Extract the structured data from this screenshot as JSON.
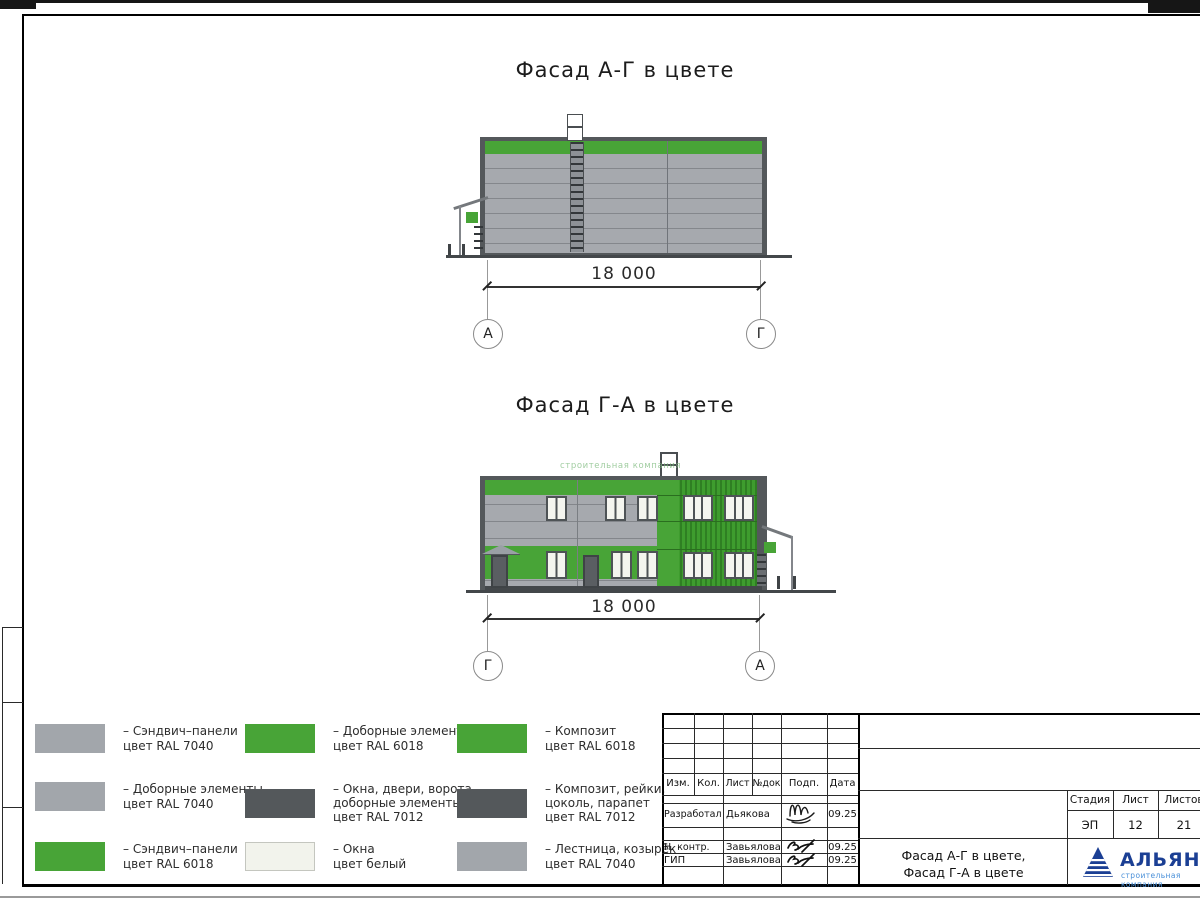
{
  "sheet": {
    "facade1": {
      "title": "Фасад А-Г в цвете",
      "dimension": "18 000",
      "axis_left": "А",
      "axis_right": "Г"
    },
    "facade2": {
      "title": "Фасад Г-А в цвете",
      "dimension": "18 000",
      "axis_left": "Г",
      "axis_right": "А",
      "watermark": "строительная компания"
    },
    "legend": {
      "items": [
        {
          "color": "#A2A6AB",
          "line1": "– Сэндвич–панели",
          "line2": "цвет RAL 7040",
          "line3": ""
        },
        {
          "color": "#A2A6AB",
          "line1": "– Доборные элементы",
          "line2": "цвет RAL 7040",
          "line3": ""
        },
        {
          "color": "#48A437",
          "line1": "– Сэндвич–панели",
          "line2": "цвет RAL 6018",
          "line3": ""
        },
        {
          "color": "#48A437",
          "line1": "– Доборные элементы",
          "line2": "цвет RAL 6018",
          "line3": ""
        },
        {
          "color": "#54585B",
          "line1": "– Окна, двери, ворота,",
          "line2": "доборные элементы",
          "line3": "цвет RAL 7012"
        },
        {
          "color": "#F2F3EC",
          "line1": "– Окна",
          "line2": "цвет белый",
          "line3": ""
        },
        {
          "color": "#48A437",
          "line1": "– Композит",
          "line2": "цвет RAL 6018",
          "line3": ""
        },
        {
          "color": "#54585B",
          "line1": "– Композит, рейки,",
          "line2": "цоколь, парапет",
          "line3": "цвет RAL 7012"
        },
        {
          "color": "#A2A6AB",
          "line1": "– Лестница, козырёк",
          "line2": "цвет RAL 7040",
          "line3": ""
        }
      ]
    },
    "titleblock": {
      "cols": {
        "izm": "Изм.",
        "kol": "Кол.",
        "list": "Лист",
        "ndok": "№док",
        "podp": "Подп.",
        "data": "Дата"
      },
      "rows": [
        {
          "role": "Разработал",
          "name": "Дьякова",
          "date": "09.25"
        },
        {
          "role": "Н. контр.",
          "name": "Завьялова",
          "date": "09.25"
        },
        {
          "role": "ГИП",
          "name": "Завьялова",
          "date": "09.25"
        }
      ],
      "stage_label": "Стадия",
      "sheet_label": "Лист",
      "sheets_label": "Листов",
      "stage": "ЭП",
      "sheet_num": "12",
      "sheets_total": "21",
      "doc_title1": "Фасад А-Г в цвете,",
      "doc_title2": "Фасад Г-А в цвете",
      "logo_name": "АЛЬЯНС",
      "logo_subtitle": "строительная компания"
    }
  }
}
